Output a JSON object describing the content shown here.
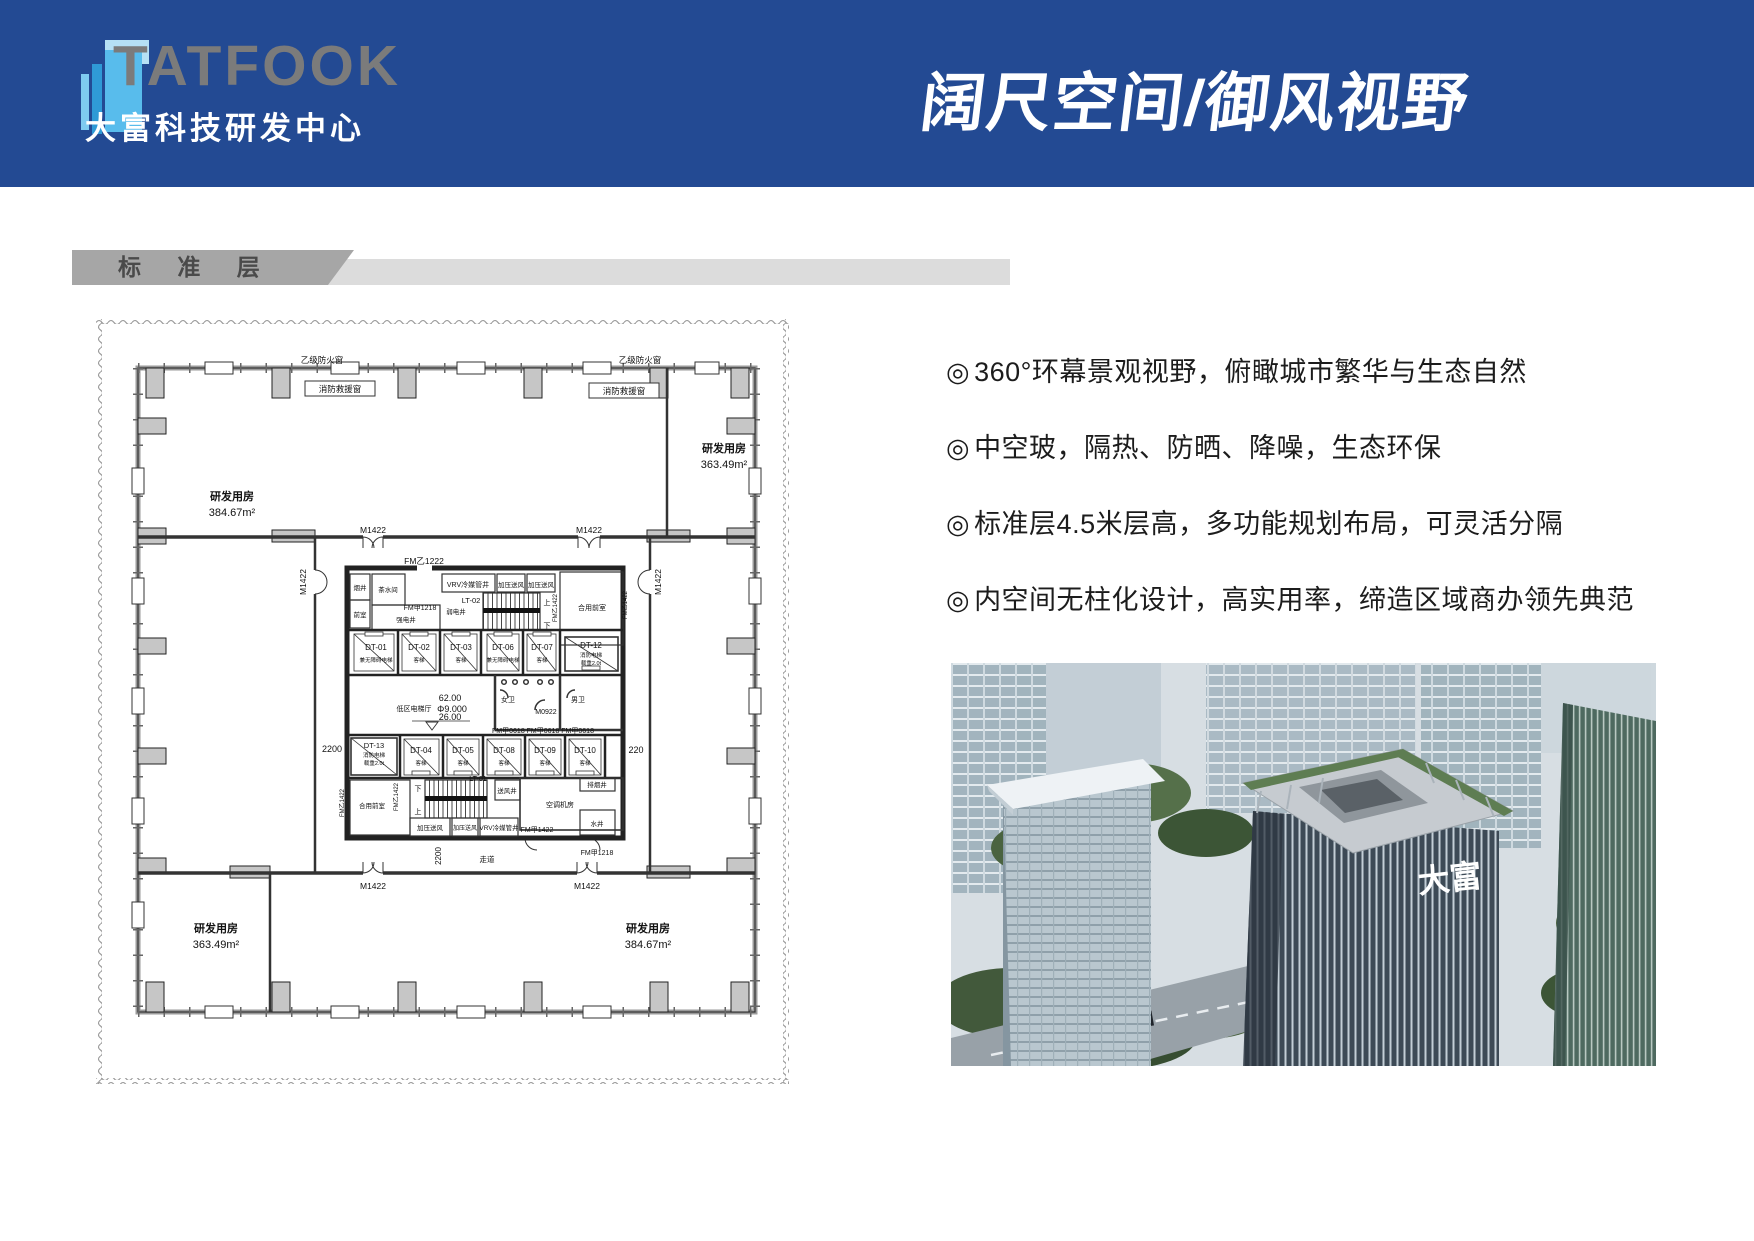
{
  "header": {
    "logo_text": "TATFOOK",
    "logo_sub": "大富科技研发中心",
    "title": "阔尺空间/御风视野"
  },
  "section": {
    "label": "标 准 层"
  },
  "features": {
    "marker": "◎",
    "items": [
      "360°环幕景观视野，俯瞰城市繁华与生态自然",
      "中空玻，隔热、防晒、降噪，生态环保",
      "标准层4.5米层高，多功能规划布局，可灵活分隔",
      "内空间无柱化设计，高实用率，缔造区域商办领先典范"
    ]
  },
  "floor_plan": {
    "rooms": {
      "tl": {
        "name": "研发用房",
        "area": "384.67m²"
      },
      "tr": {
        "name": "研发用房",
        "area": "363.49m²"
      },
      "bl": {
        "name": "研发用房",
        "area": "363.49m²"
      },
      "br": {
        "name": "研发用房",
        "area": "384.67m²"
      }
    },
    "ann": {
      "fire_window": "乙级防火窗",
      "rescue_window": "消防救援窗",
      "m1422": "M1422",
      "m0922": "M0922",
      "fmy1222": "FM乙1222",
      "fmy1422": "FM乙1422",
      "fmj1218": "FM甲1218",
      "fmj1422": "FM甲1422",
      "fmj0618_row": "FM甲0618 FM甲0618 FM甲0618",
      "d2200": "2200",
      "d220": "220",
      "corridor": "走道",
      "lobby": "低区电梯厅",
      "lv62": "62.00",
      "lv9": "Φ9.000",
      "lv26": "26.00",
      "up": "上",
      "down": "下"
    },
    "core": {
      "smoke": "烟井",
      "tea": "茶水间",
      "vrv": "VRV冷媒管井",
      "press": "加压送风",
      "strong": "强电井",
      "weak": "弱电井",
      "front": "前室",
      "shared_front": "合用前室",
      "womens": "女卫",
      "mens": "男卫",
      "ac": "空调机房",
      "water": "水井",
      "exhaust": "排烟井",
      "supply": "送风井",
      "cab": "客梯",
      "accessible": "兼无障碍电梯",
      "fire_note": "消防电梯",
      "load_note": "载重2.0t",
      "lt01": "LT-01",
      "lt02": "LT-02"
    },
    "lifts1": [
      "DT-01",
      "DT-02",
      "DT-03",
      "DT-06",
      "DT-07",
      "DT-12"
    ],
    "lifts2": [
      "DT-13",
      "DT-04",
      "DT-05",
      "DT-08",
      "DT-09",
      "DT-10"
    ]
  },
  "photo": {
    "building_sign": "大富"
  }
}
